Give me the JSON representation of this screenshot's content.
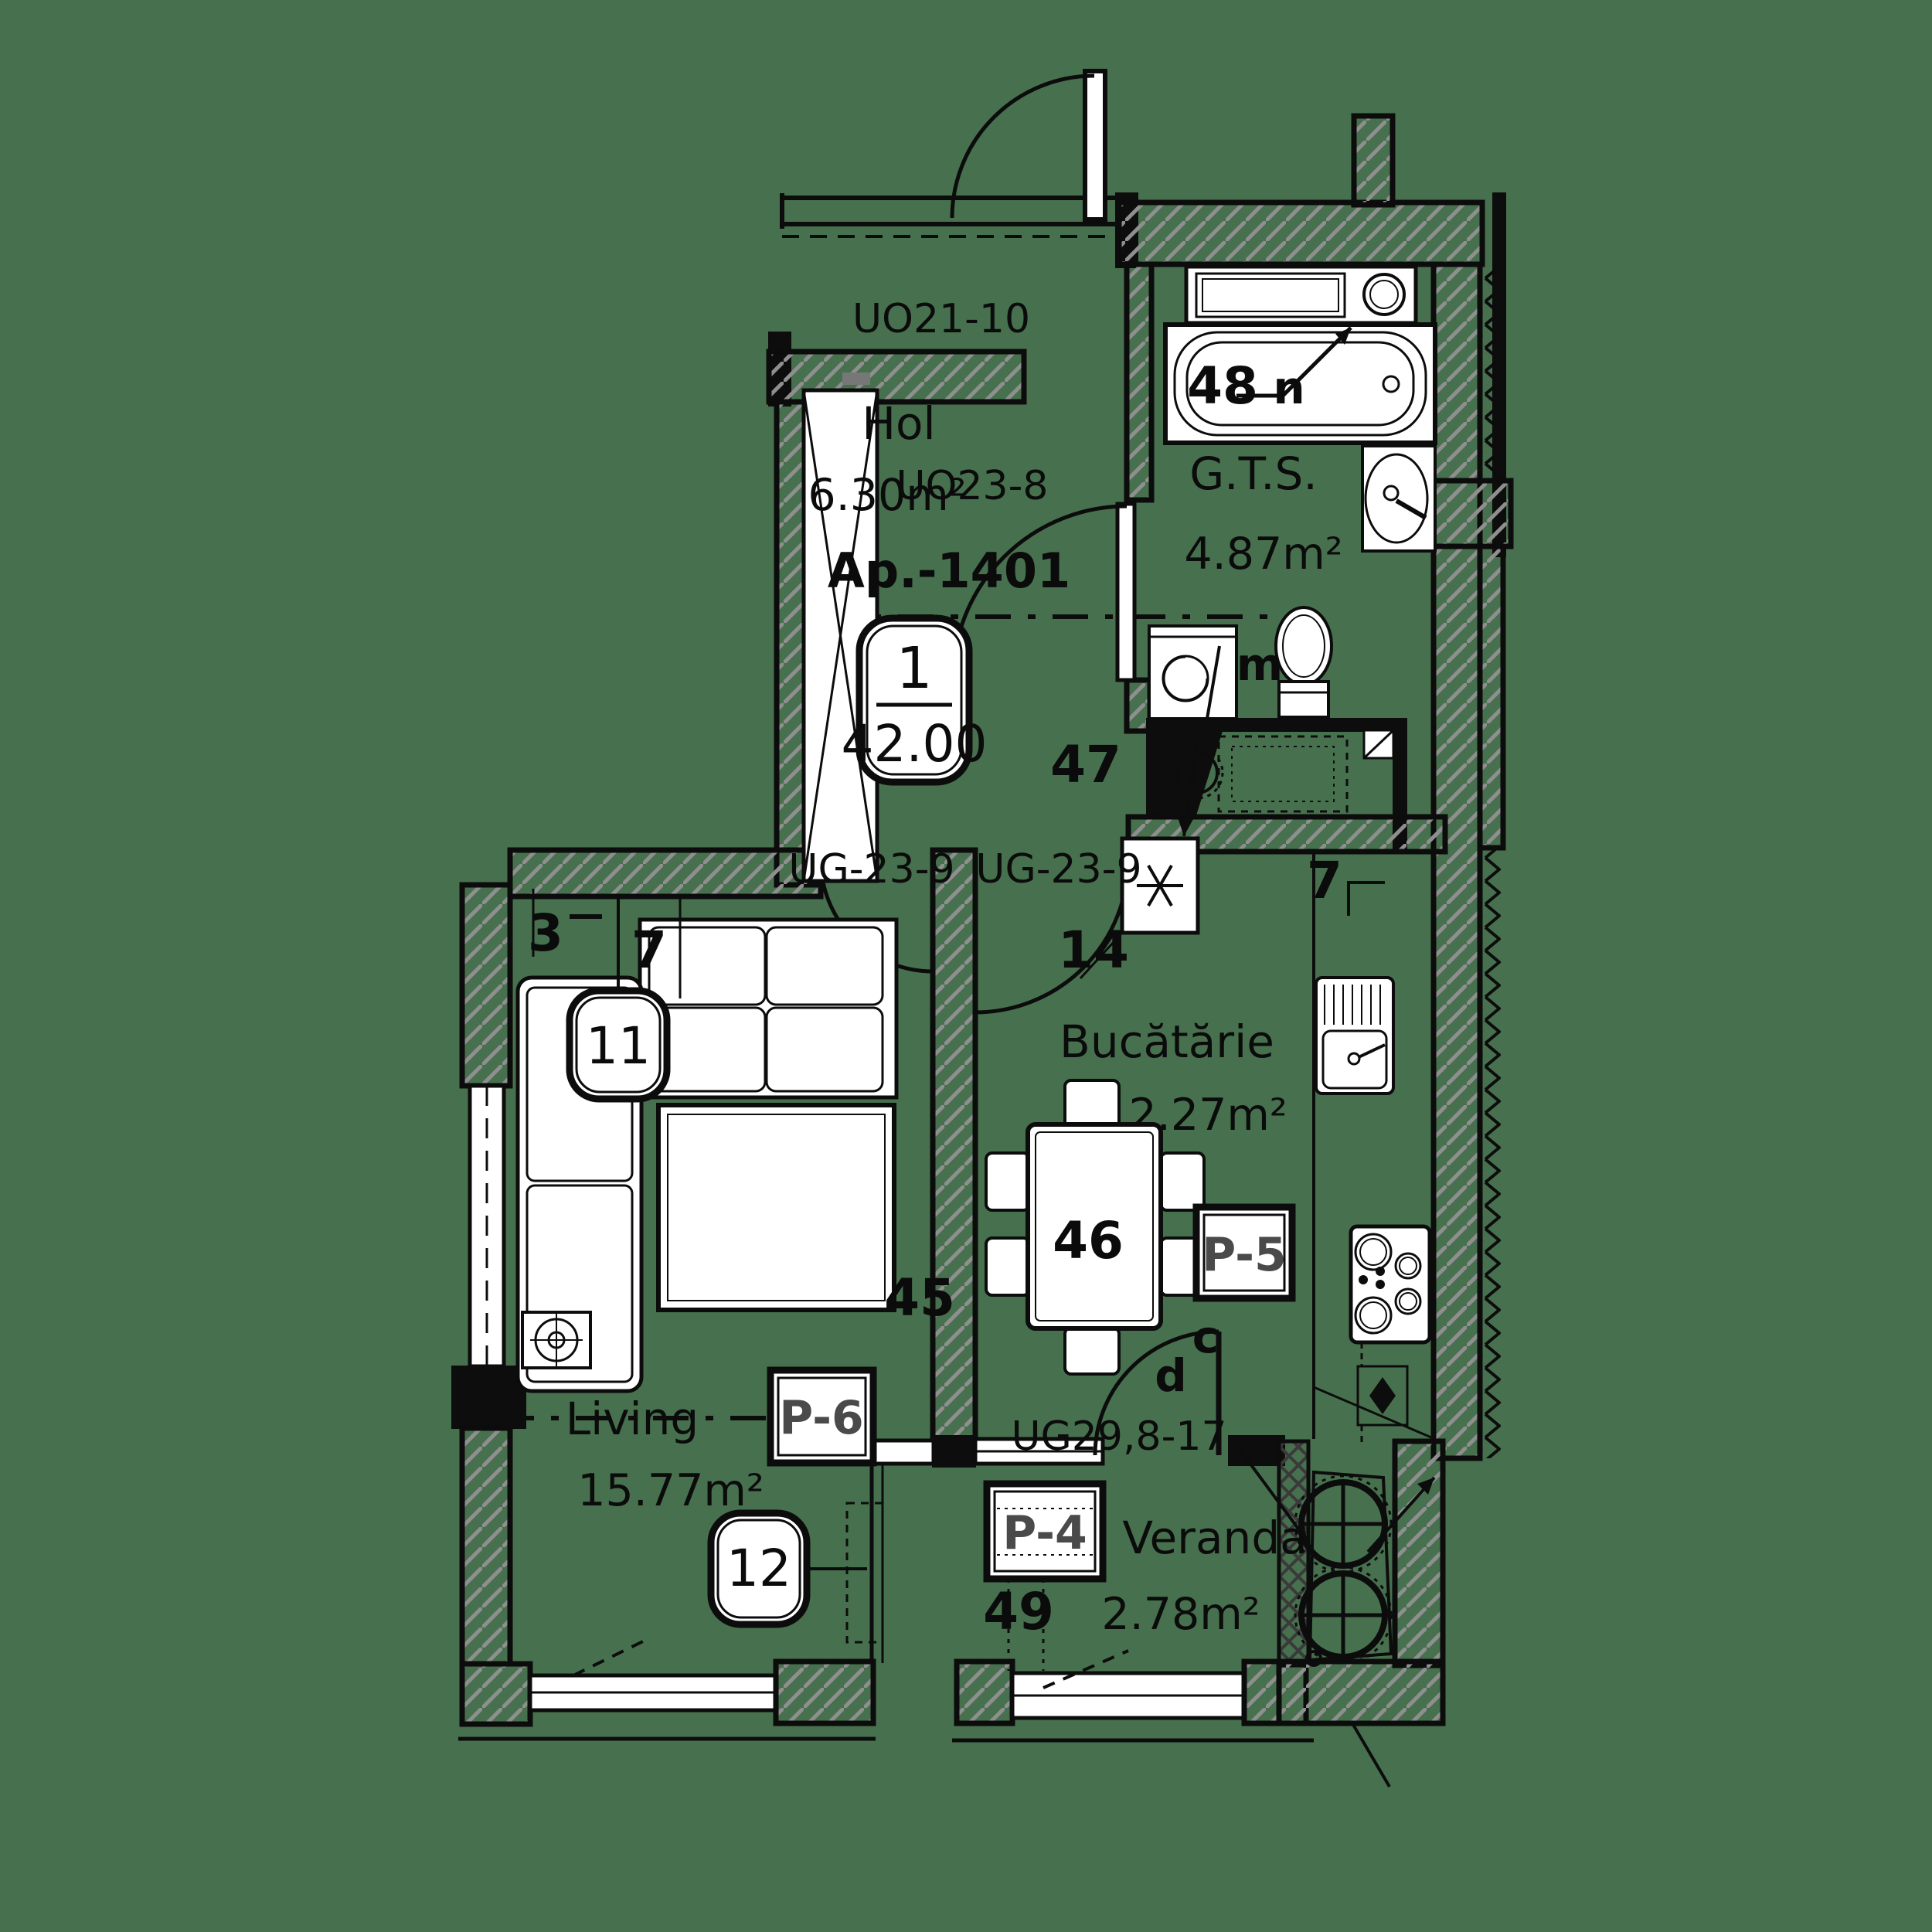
{
  "title": "Apartment floor plan Ap.-1401",
  "colors": {
    "background": "#47714E",
    "ink": "#0c0c0c",
    "hatch_gray": "#8f8f8f",
    "marker_gray": "#4a4a4a",
    "fixture_white": "#ffffff"
  },
  "apartment": {
    "label": "Ap.-1401",
    "unit_number": "1",
    "total_area": "42.00"
  },
  "rooms": {
    "hol": {
      "name": "Hol",
      "area": "6.30m²"
    },
    "gts": {
      "name": "G.T.S.",
      "area": "4.87m²"
    },
    "kitchen": {
      "name": "Bucătărie",
      "area": "12.27m²"
    },
    "living": {
      "name": "Living",
      "area": "15.77m²"
    },
    "veranda": {
      "name": "Veranda",
      "area": "2.78m²"
    }
  },
  "doors": {
    "entry": "UO21-10",
    "bathroom": "UO23-8",
    "living": "UG-23-9",
    "kitchen": "UG-23-9",
    "veranda": "UG29,8-17"
  },
  "windows": {
    "p4": "P-4",
    "p5": "P-5",
    "p6": "P-6"
  },
  "space_numbers": {
    "s45": "45",
    "s46": "46",
    "s47": "47",
    "s48": "48",
    "s49": "49"
  },
  "callouts": {
    "c11": "11",
    "c12": "12",
    "c14": "14"
  },
  "axis_ticks": {
    "a3": "3",
    "a7_living": "7",
    "a7_kitchen": "7"
  },
  "letters": {
    "bath_n": "n",
    "wc_m": "m",
    "door_c": "c",
    "door_d": "d"
  }
}
